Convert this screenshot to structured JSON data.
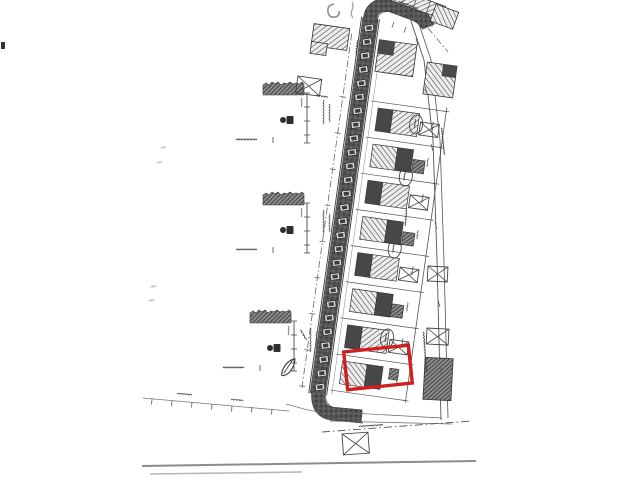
{
  "document": {
    "kind_label": "",
    "colors": {
      "ink": "#3b3b3b",
      "ink_light": "#777777",
      "pencil": "#9a9a9a",
      "road_fill": "#565656",
      "highlight": "#d01f1f",
      "paper": "#ffffff",
      "page_edge": "#8c8c8c"
    }
  },
  "plan": {
    "strip_rotation_deg": 8,
    "road": {
      "band": {
        "x": 362,
        "y": 18,
        "w": 16,
        "h": 380
      },
      "parking": {
        "count": 27,
        "x1": 369,
        "y1": 28,
        "x2": 320,
        "y2": 387,
        "tilt": -8
      }
    },
    "plots": {
      "rows": [
        100,
        136.5,
        173,
        209.5,
        246,
        282.5,
        319,
        355.5,
        392
      ],
      "house_count": 8
    },
    "garages_local": [
      {
        "x": 434,
        "y": 114
      },
      {
        "x": 434,
        "y": 187.5
      },
      {
        "x": 434,
        "y": 260.5
      },
      {
        "x": 434,
        "y": 333.5
      }
    ],
    "garages_global": [
      {
        "x": 298,
        "y": 76,
        "w": 24,
        "h": 17,
        "rot": 8
      },
      {
        "x": 428,
        "y": 266,
        "w": 20,
        "h": 15,
        "rot": 3
      },
      {
        "x": 427,
        "y": 328,
        "w": 22,
        "h": 16,
        "rot": 3
      },
      {
        "x": 342,
        "y": 434,
        "w": 26,
        "h": 21,
        "rot": -4
      }
    ],
    "ellipses_local": [
      {
        "x": 430,
        "y": 117
      },
      {
        "x": 427,
        "y": 170
      },
      {
        "x": 426,
        "y": 243
      },
      {
        "x": 431,
        "y": 333
      }
    ],
    "sheds_local": [
      {
        "x": 432,
        "y": 152,
        "w": 12,
        "h": 13
      },
      {
        "x": 432,
        "y": 225,
        "w": 12,
        "h": 13
      },
      {
        "x": 431,
        "y": 298,
        "w": 12,
        "h": 13
      },
      {
        "x": 438,
        "y": 362,
        "w": 9,
        "h": 11
      }
    ],
    "sections": [
      {
        "x": 263,
        "y": 80
      },
      {
        "x": 263,
        "y": 190
      },
      {
        "x": 250,
        "y": 308
      }
    ],
    "microtext": [
      {
        "x": 441,
        "y": 128,
        "len": 26,
        "rot": 84
      },
      {
        "x": 423,
        "y": 332,
        "len": 38,
        "rot": 86
      },
      {
        "x": 406,
        "y": 208,
        "len": 16,
        "rot": 94
      },
      {
        "x": 357,
        "y": 40,
        "len": 14,
        "rot": 96
      },
      {
        "x": 359,
        "y": 427,
        "len": 22,
        "rot": -4
      },
      {
        "x": 177,
        "y": 394,
        "len": 13,
        "rot": 5
      },
      {
        "x": 231,
        "y": 400,
        "len": 11,
        "rot": 5
      },
      {
        "x": 300,
        "y": 330,
        "len": 12,
        "rot": 60
      },
      {
        "x": 398,
        "y": 2,
        "len": 20,
        "rot": 20
      },
      {
        "x": 316,
        "y": 96,
        "len": 10,
        "rot": 8
      }
    ],
    "ticks_right_street": [
      {
        "x": 416,
        "y": 38
      },
      {
        "x": 425,
        "y": 86
      },
      {
        "x": 431,
        "y": 144
      },
      {
        "x": 435,
        "y": 222
      },
      {
        "x": 438,
        "y": 300
      },
      {
        "x": 440,
        "y": 368
      }
    ],
    "ticks_top_street": [
      {
        "x": 398,
        "y": 4
      },
      {
        "x": 410,
        "y": 9
      },
      {
        "x": 422,
        "y": 15
      },
      {
        "x": 434,
        "y": 21
      },
      {
        "x": 394,
        "y": 22
      },
      {
        "x": 406,
        "y": 27
      }
    ],
    "ticks_left_dim": [
      {
        "x": 152,
        "y": 399
      },
      {
        "x": 172,
        "y": 401
      },
      {
        "x": 192,
        "y": 402
      },
      {
        "x": 212,
        "y": 404
      },
      {
        "x": 232,
        "y": 406
      },
      {
        "x": 252,
        "y": 407
      },
      {
        "x": 272,
        "y": 409
      }
    ],
    "smudges": [
      {
        "x": 160,
        "y": 148
      },
      {
        "x": 156,
        "y": 163
      },
      {
        "x": 150,
        "y": 287
      },
      {
        "x": 148,
        "y": 301
      }
    ],
    "red_highlight": {
      "cx": 378,
      "cy": 367.5,
      "w": 65,
      "h": 38,
      "rot": -6,
      "stroke_w": 3.4
    }
  }
}
